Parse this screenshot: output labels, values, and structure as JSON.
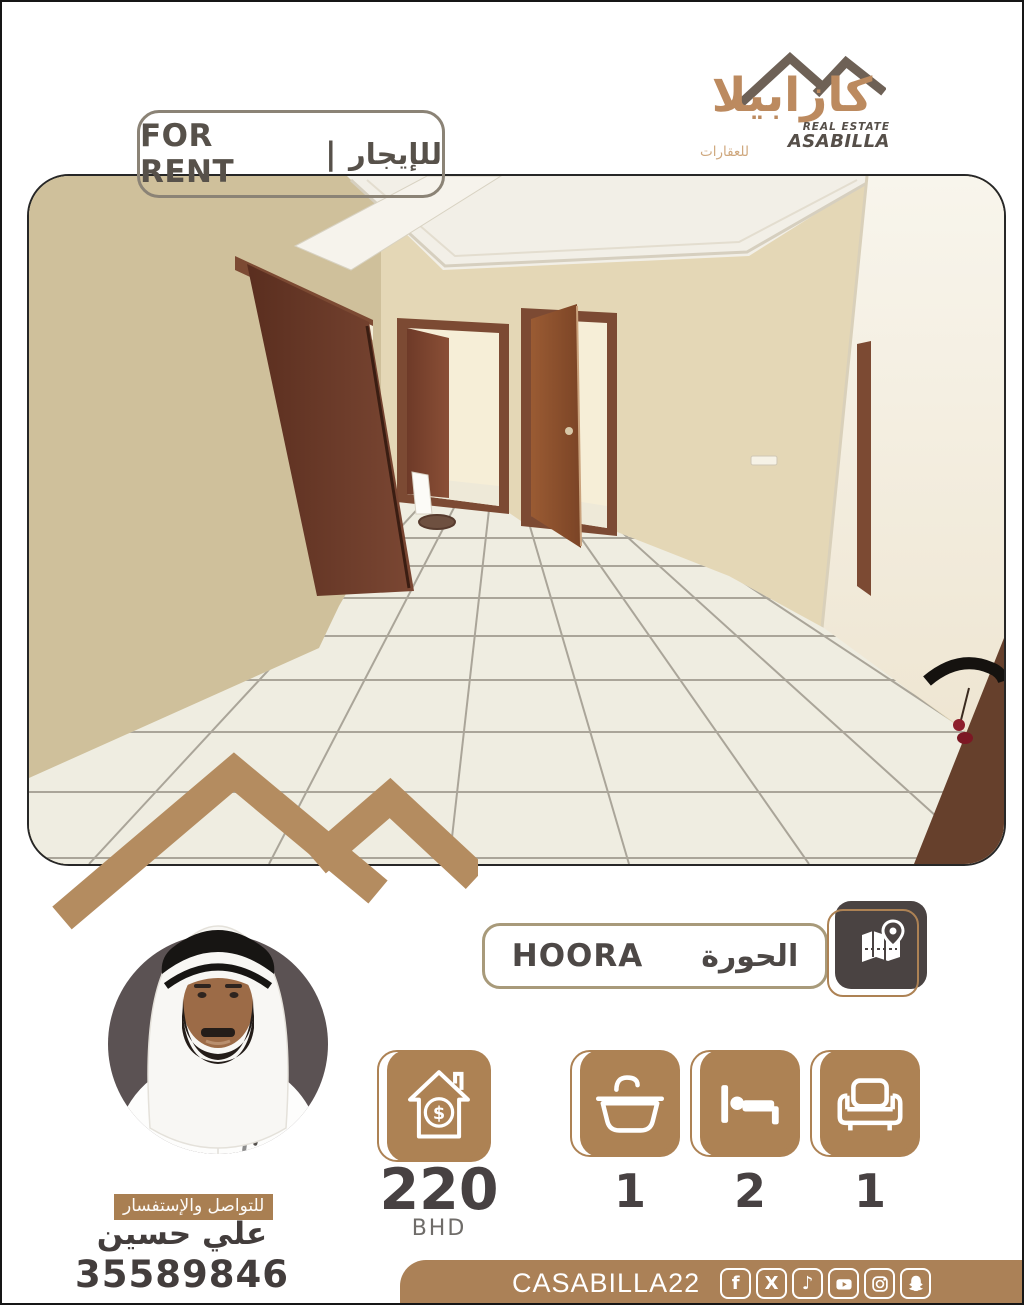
{
  "rent_badge": {
    "en": "FOR RENT",
    "sep": "|",
    "ar": "للإيجار"
  },
  "logo": {
    "name_ar": "كازابيلا",
    "tagline_line1": "REAL ESTATE",
    "tagline_line2": "ASABILLA",
    "sub_ar": "للعقارات"
  },
  "location": {
    "en": "HOORA",
    "ar": "الحورة"
  },
  "price": {
    "amount": "220",
    "currency": "BHD"
  },
  "features": [
    {
      "label": "bathrooms",
      "count": "1"
    },
    {
      "label": "bedrooms",
      "count": "2"
    },
    {
      "label": "living-rooms",
      "count": "1"
    }
  ],
  "contact": {
    "heading_ar": "للتواصل والإستفسار",
    "name_ar": "علي حسين",
    "phone": "35589846"
  },
  "footer": {
    "handle": "CASABILLA22"
  },
  "colors": {
    "accent": "#ad8254",
    "watermark": "#b48c60",
    "dark_text": "#474142",
    "tile_dark": "#4a4342",
    "footer_bg": "#ab8157",
    "badge_border": "#8b8376"
  }
}
